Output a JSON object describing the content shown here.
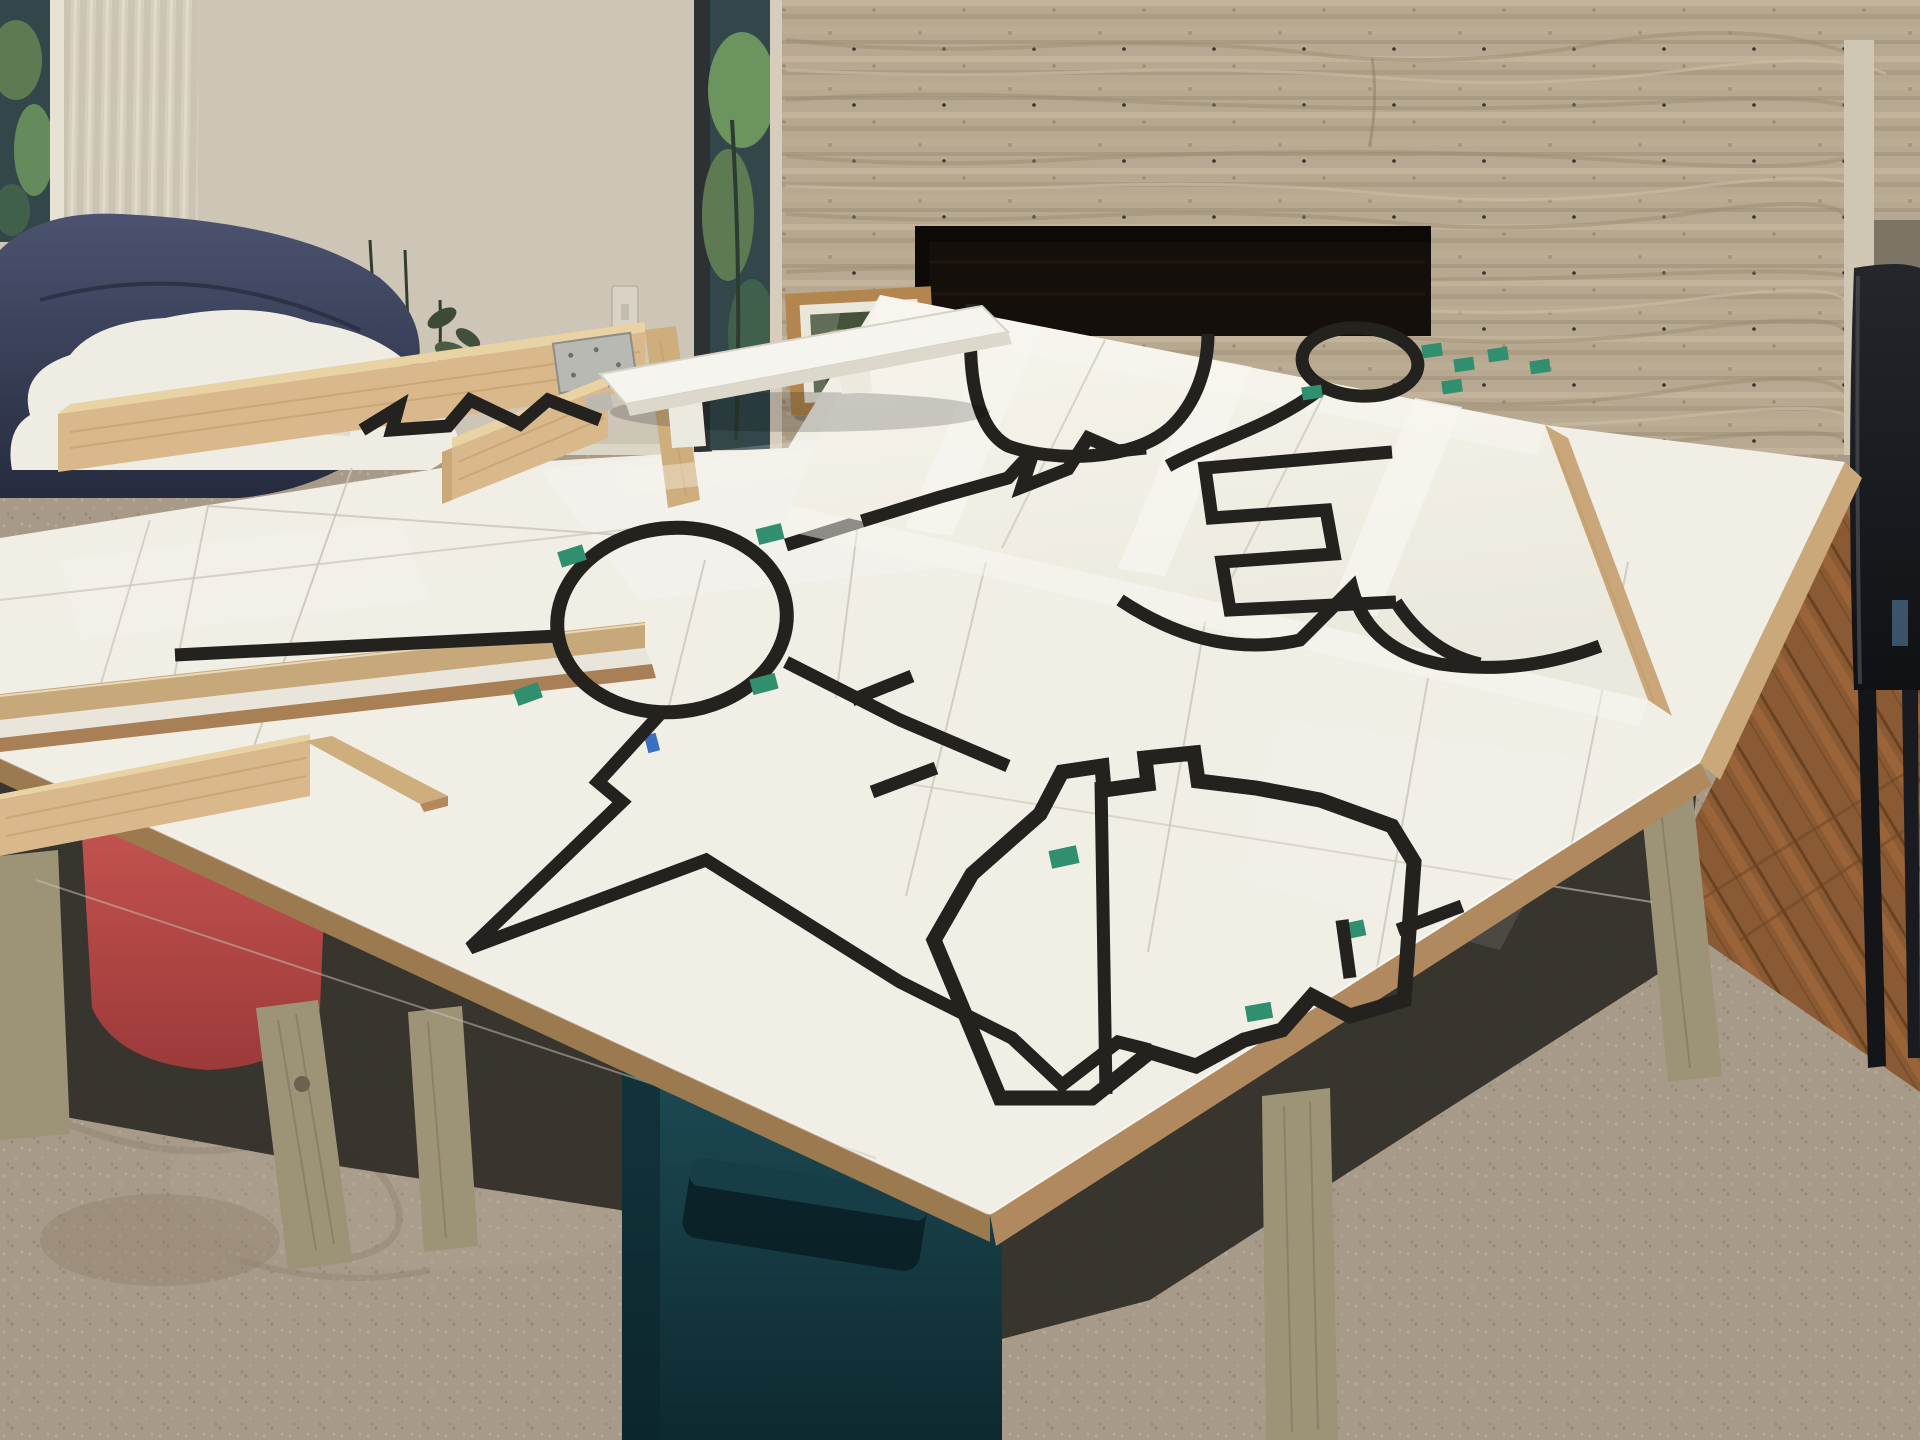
{
  "meta": {
    "title": "Living room with DIY white practice table and black-tape robot line course",
    "type": "photograph",
    "visible_text": "none"
  },
  "scene": {
    "setting": "living room with travertine fireplace wall",
    "objects": [
      {
        "id": "travertine-wall",
        "label": "Travertine stone accent wall"
      },
      {
        "id": "fireplace",
        "label": "Dark fireplace opening"
      },
      {
        "id": "window-left",
        "label": "Window with sheer curtain"
      },
      {
        "id": "window-right",
        "label": "Tall window with greenery outside"
      },
      {
        "id": "light-switch",
        "label": "Wall light switch"
      },
      {
        "id": "framed-picture",
        "label": "Framed botanical print leaning against wall"
      },
      {
        "id": "orchid-plant",
        "label": "Orchid plant stems"
      },
      {
        "id": "navy-lounge-chair",
        "label": "Navy leather lounge chair"
      },
      {
        "id": "white-blanket",
        "label": "White fluffy blanket"
      },
      {
        "id": "black-side-chair",
        "label": "Black side chair"
      },
      {
        "id": "practice-table",
        "label": "Plywood table with white panels and taped line course"
      },
      {
        "id": "tilted-panel",
        "label": "Tilted white course panel leaning on table"
      },
      {
        "id": "ramp",
        "label": "Small raised ramp panel on blocks"
      },
      {
        "id": "pine-rails",
        "label": "Pine board border rails with metal brackets"
      },
      {
        "id": "roundabout",
        "label": "Black tape roundabout circle with spokes"
      },
      {
        "id": "castle-loop",
        "label": "Closed black tape loop with castellated notches"
      },
      {
        "id": "lollipop",
        "label": "Small black tape circle with curved stem"
      },
      {
        "id": "green-markers",
        "label": "Green tape junction markers"
      },
      {
        "id": "red-tub",
        "label": "Red flexible plastic tub under table"
      },
      {
        "id": "teal-bin",
        "label": "Dark teal storage bin under table"
      },
      {
        "id": "table-legs",
        "label": "Pressure-treated wood legs"
      },
      {
        "id": "area-rug",
        "label": "Beige textured area rug"
      },
      {
        "id": "hardwood-floor",
        "label": "Oak hardwood floor"
      }
    ],
    "counts": {
      "green_markers": 14,
      "track_dashes": 3,
      "wood_rails": 5,
      "table_legs_visible": 5
    }
  },
  "palette": {
    "wall": "#cdc5b6",
    "curtain_a": "#d6cfc0",
    "curtain_b": "#c9c2b2",
    "stone": "#b7a891",
    "stone_dark": "#9c8b73",
    "stone_light": "#c8baa3",
    "fireplace": "#140f0a",
    "glass": "#33474a",
    "foliage": "#5d7a52",
    "foliage_light": "#729c60",
    "frame_wood": "#b3854f",
    "mat": "#e9e6dc",
    "art": "#45523a",
    "navy": "#4b5370",
    "navy_dark": "#262b3e",
    "blanket": "#efece3",
    "white_panel": "#f1eee6",
    "panel_bright": "#f6f3eb",
    "tape": "#23221e",
    "green": "#2f8f6e",
    "tape_white": "#f7f5ee",
    "pine": "#d9b98c",
    "pine_light": "#e9d2a4",
    "pine_dark": "#bd9662",
    "ply": "#b08a5e",
    "ply_dark": "#9c7a50",
    "leg": "#9d9377",
    "tub": "#c24949",
    "tub_dark": "#9c3a3a",
    "bin": "#1d4a53",
    "bin_dark": "#0e2930",
    "rug": "#a89a88",
    "rug_light": "#b7aa97",
    "rug_dark": "#8d7f6e",
    "wood_floor": "#8a5a34",
    "wood_floor_dark": "#6e4526",
    "chair_black": "#17181c",
    "shadow": "#2f2b26",
    "seam": "#c9c4b8",
    "metal": "#b9b9b3",
    "trim": "#cfc6b3",
    "blue_tape": "#3b6fc4"
  }
}
